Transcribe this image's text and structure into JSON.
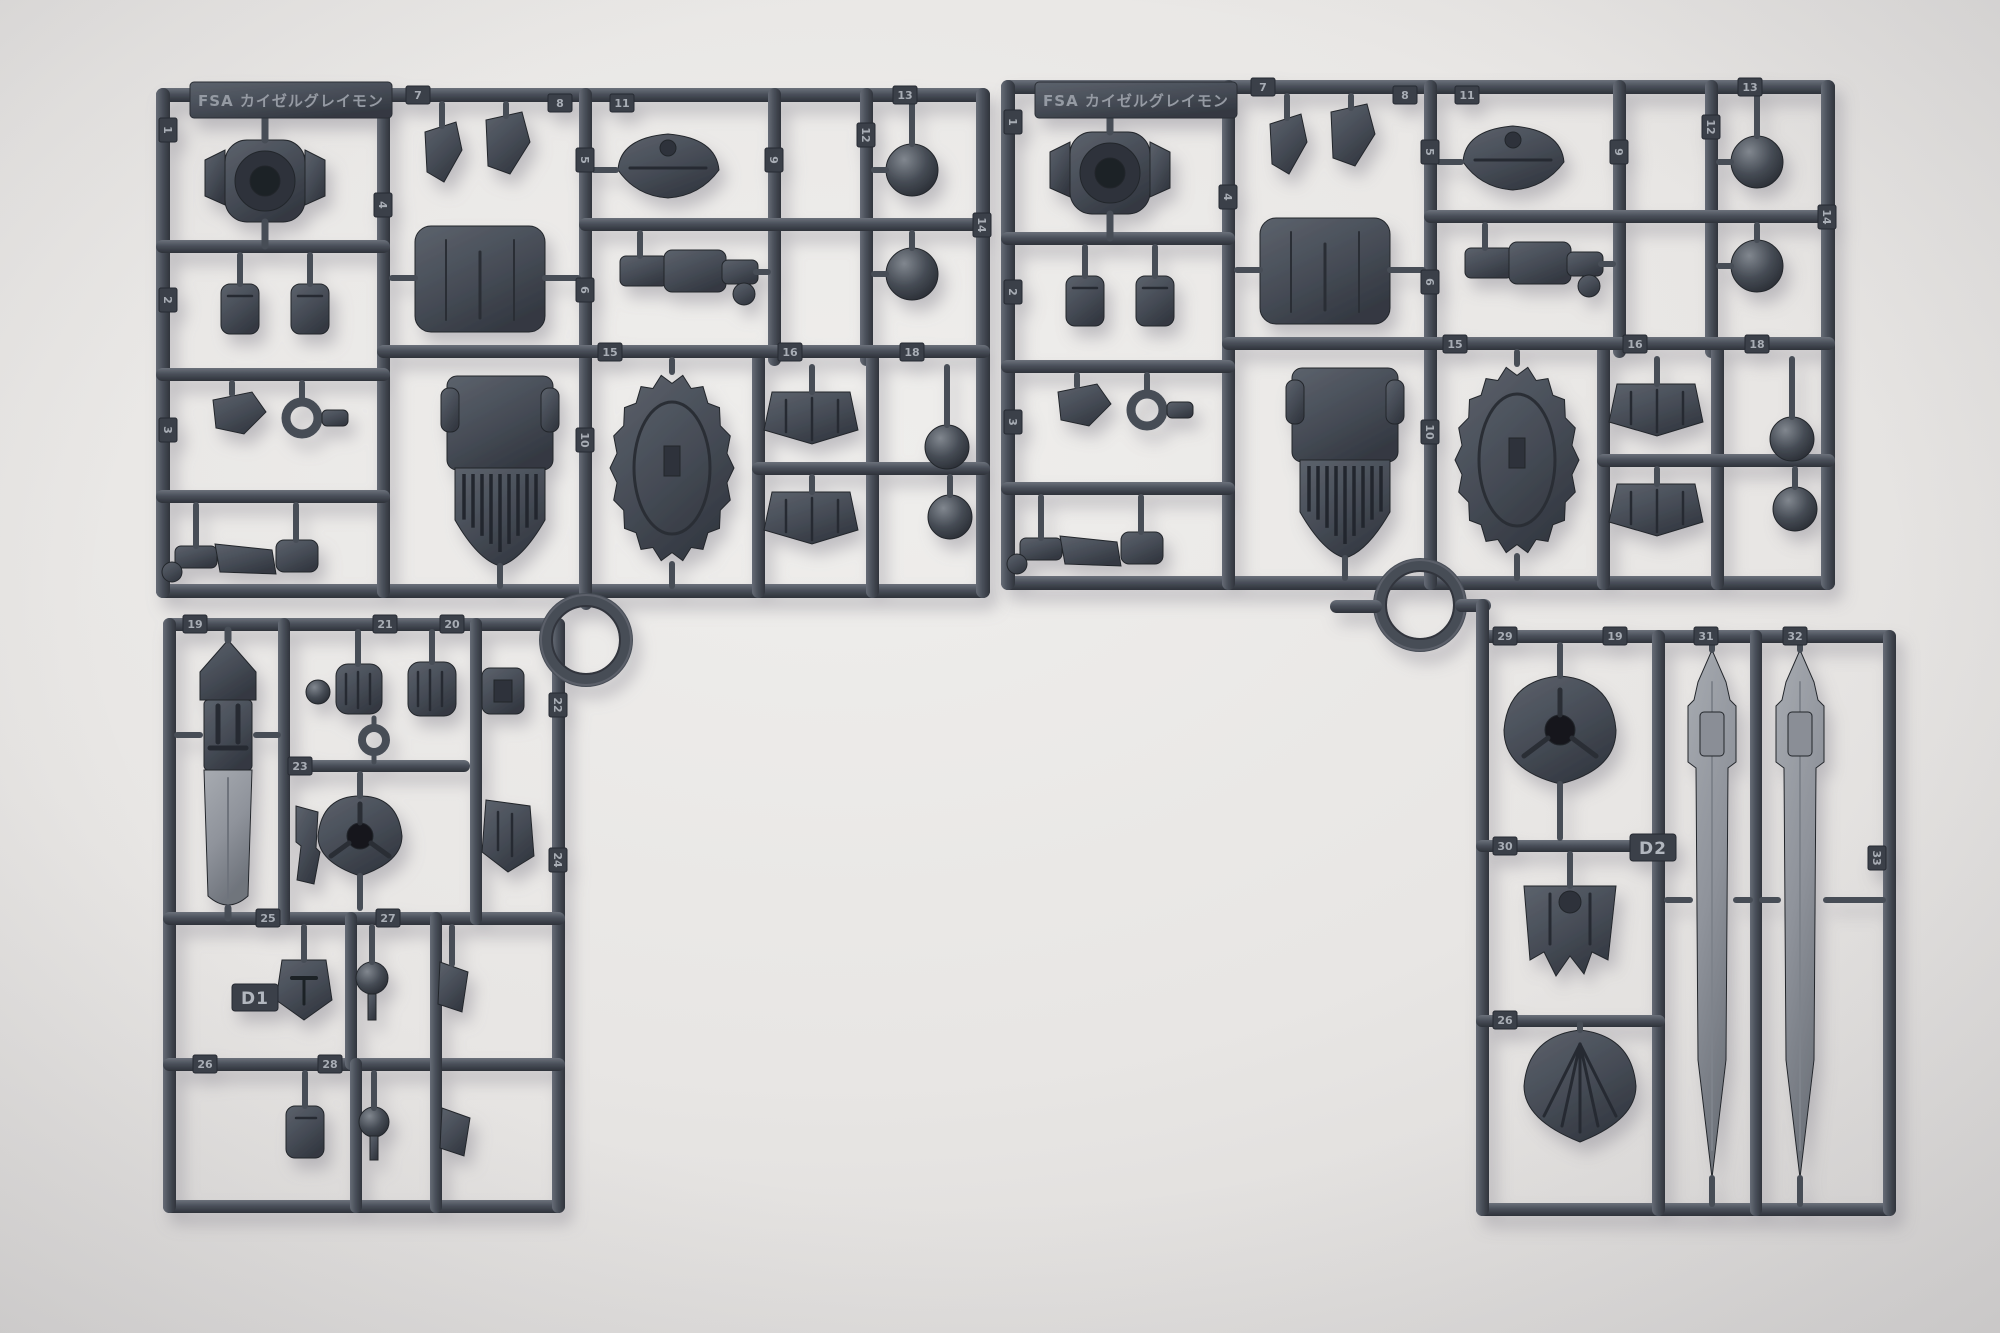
{
  "photo": {
    "subject": "Two dark gray plastic model-kit part runners (sprues) with molded robot armor parts, ball joints and swords, photographed on a light gray surface",
    "background_color": "#ebe9e7",
    "plastic_color": "#474d57",
    "plastic_highlight": "#7b818b",
    "plastic_shadow": "#2b2f36",
    "light_part_color": "#999da4"
  },
  "sprues": [
    {
      "name": "left-runner",
      "molded_label": "FSA カイゼルグレイモン",
      "runner_id": "D1",
      "upper_tags": [
        {
          "n": "1",
          "x": 168,
          "y": 130,
          "r": 90
        },
        {
          "n": "2",
          "x": 168,
          "y": 300,
          "r": 90
        },
        {
          "n": "3",
          "x": 168,
          "y": 430,
          "r": 90
        },
        {
          "n": "4",
          "x": 383,
          "y": 205,
          "r": 90
        },
        {
          "n": "5",
          "x": 585,
          "y": 160,
          "r": 90
        },
        {
          "n": "6",
          "x": 585,
          "y": 290,
          "r": 90
        },
        {
          "n": "7",
          "x": 418,
          "y": 95,
          "r": 0
        },
        {
          "n": "8",
          "x": 560,
          "y": 103,
          "r": 0
        },
        {
          "n": "9",
          "x": 774,
          "y": 160,
          "r": 90
        },
        {
          "n": "10",
          "x": 585,
          "y": 440,
          "r": 90
        },
        {
          "n": "11",
          "x": 622,
          "y": 103,
          "r": 0
        },
        {
          "n": "12",
          "x": 866,
          "y": 135,
          "r": 90
        },
        {
          "n": "13",
          "x": 905,
          "y": 95,
          "r": 0
        },
        {
          "n": "14",
          "x": 982,
          "y": 225,
          "r": 90
        },
        {
          "n": "15",
          "x": 610,
          "y": 352,
          "r": 0
        },
        {
          "n": "16",
          "x": 790,
          "y": 352,
          "r": 0
        },
        {
          "n": "18",
          "x": 912,
          "y": 352,
          "r": 0
        }
      ],
      "lower_tags": [
        {
          "n": "19",
          "x": 195,
          "y": 624,
          "r": 0
        },
        {
          "n": "20",
          "x": 452,
          "y": 624,
          "r": 0
        },
        {
          "n": "21",
          "x": 385,
          "y": 624,
          "r": 0
        },
        {
          "n": "22",
          "x": 558,
          "y": 705,
          "r": 90
        },
        {
          "n": "23",
          "x": 300,
          "y": 766,
          "r": 0
        },
        {
          "n": "24",
          "x": 558,
          "y": 860,
          "r": 90
        },
        {
          "n": "25",
          "x": 268,
          "y": 918,
          "r": 0
        },
        {
          "n": "26",
          "x": 205,
          "y": 1064,
          "r": 0
        },
        {
          "n": "27",
          "x": 388,
          "y": 918,
          "r": 0
        },
        {
          "n": "28",
          "x": 330,
          "y": 1064,
          "r": 0
        }
      ]
    },
    {
      "name": "right-runner",
      "molded_label": "FSA カイゼルグレイモン",
      "runner_id": "D2",
      "upper_tags": [
        {
          "n": "1",
          "x": 168,
          "y": 130,
          "r": 90
        },
        {
          "n": "2",
          "x": 168,
          "y": 300,
          "r": 90
        },
        {
          "n": "3",
          "x": 168,
          "y": 430,
          "r": 90
        },
        {
          "n": "4",
          "x": 383,
          "y": 205,
          "r": 90
        },
        {
          "n": "5",
          "x": 585,
          "y": 160,
          "r": 90
        },
        {
          "n": "6",
          "x": 585,
          "y": 290,
          "r": 90
        },
        {
          "n": "7",
          "x": 418,
          "y": 95,
          "r": 0
        },
        {
          "n": "8",
          "x": 560,
          "y": 103,
          "r": 0
        },
        {
          "n": "9",
          "x": 774,
          "y": 160,
          "r": 90
        },
        {
          "n": "10",
          "x": 585,
          "y": 440,
          "r": 90
        },
        {
          "n": "11",
          "x": 622,
          "y": 103,
          "r": 0
        },
        {
          "n": "12",
          "x": 866,
          "y": 135,
          "r": 90
        },
        {
          "n": "13",
          "x": 905,
          "y": 95,
          "r": 0
        },
        {
          "n": "14",
          "x": 982,
          "y": 225,
          "r": 90
        },
        {
          "n": "15",
          "x": 610,
          "y": 352,
          "r": 0
        },
        {
          "n": "16",
          "x": 790,
          "y": 352,
          "r": 0
        },
        {
          "n": "18",
          "x": 912,
          "y": 352,
          "r": 0
        }
      ],
      "lower_tags": [
        {
          "n": "19",
          "x": 1615,
          "y": 636,
          "r": 0
        },
        {
          "n": "29",
          "x": 1505,
          "y": 636,
          "r": 0
        },
        {
          "n": "30",
          "x": 1505,
          "y": 846,
          "r": 0
        },
        {
          "n": "31",
          "x": 1706,
          "y": 636,
          "r": 0
        },
        {
          "n": "32",
          "x": 1795,
          "y": 636,
          "r": 0
        },
        {
          "n": "33",
          "x": 1877,
          "y": 858,
          "r": 90
        },
        {
          "n": "26",
          "x": 1505,
          "y": 1020,
          "r": 0
        }
      ]
    }
  ]
}
